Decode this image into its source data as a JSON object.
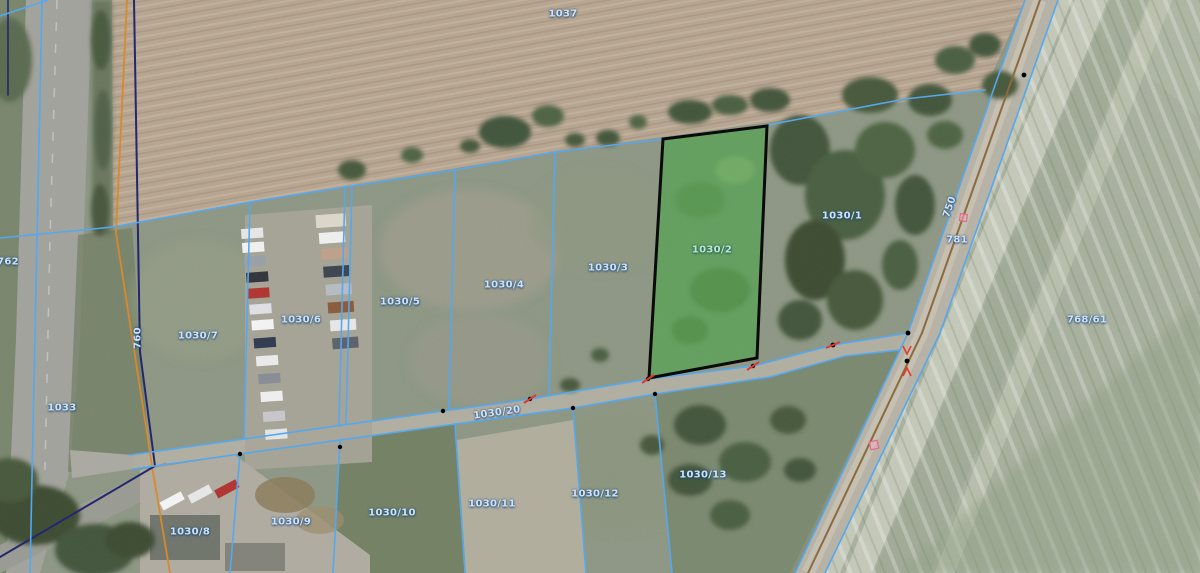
{
  "map": {
    "description_labels_note": "cadastral parcel identifiers visible on aerial map",
    "region_labels": [
      {
        "id": "parcel-1037",
        "text": "1037"
      },
      {
        "id": "parcel-762",
        "text": "762"
      },
      {
        "id": "parcel-1033",
        "text": "1033"
      },
      {
        "id": "road-760",
        "text": "760"
      },
      {
        "id": "parcel-1030-7",
        "text": "1030/7"
      },
      {
        "id": "parcel-1030-6",
        "text": "1030/6"
      },
      {
        "id": "parcel-1030-5",
        "text": "1030/5"
      },
      {
        "id": "parcel-1030-4",
        "text": "1030/4"
      },
      {
        "id": "parcel-1030-3",
        "text": "1030/3"
      },
      {
        "id": "parcel-1030-2",
        "text": "1030/2"
      },
      {
        "id": "parcel-1030-1",
        "text": "1030/1"
      },
      {
        "id": "road-750",
        "text": "750"
      },
      {
        "id": "parcel-781",
        "text": "781"
      },
      {
        "id": "parcel-768-61",
        "text": "768/61"
      },
      {
        "id": "parcel-1030-20",
        "text": "1030/20"
      },
      {
        "id": "parcel-1030-13",
        "text": "1030/13"
      },
      {
        "id": "parcel-1030-12",
        "text": "1030/12"
      },
      {
        "id": "parcel-1030-11",
        "text": "1030/11"
      },
      {
        "id": "parcel-1030-10",
        "text": "1030/10"
      },
      {
        "id": "parcel-1030-9",
        "text": "1030/9"
      },
      {
        "id": "parcel-1030-8",
        "text": "1030/8"
      }
    ],
    "highlighted_parcel": {
      "label": "1030/2",
      "fill": "#3ea83e",
      "stroke": "#000000"
    },
    "palette": {
      "parcel_boundary_line": "#54a8f0",
      "road_cadastral_line_orange": "#d8892b",
      "survey_line_navy": "#23276e",
      "road_centerline_brown": "#8a6a3f",
      "label_text": "#cfe3f8",
      "label_text_highlight": "#bfe6d8",
      "marker_red": "#e03a2a",
      "marker_pink": "#ef9db4",
      "vertex_dot": "#000000"
    }
  }
}
